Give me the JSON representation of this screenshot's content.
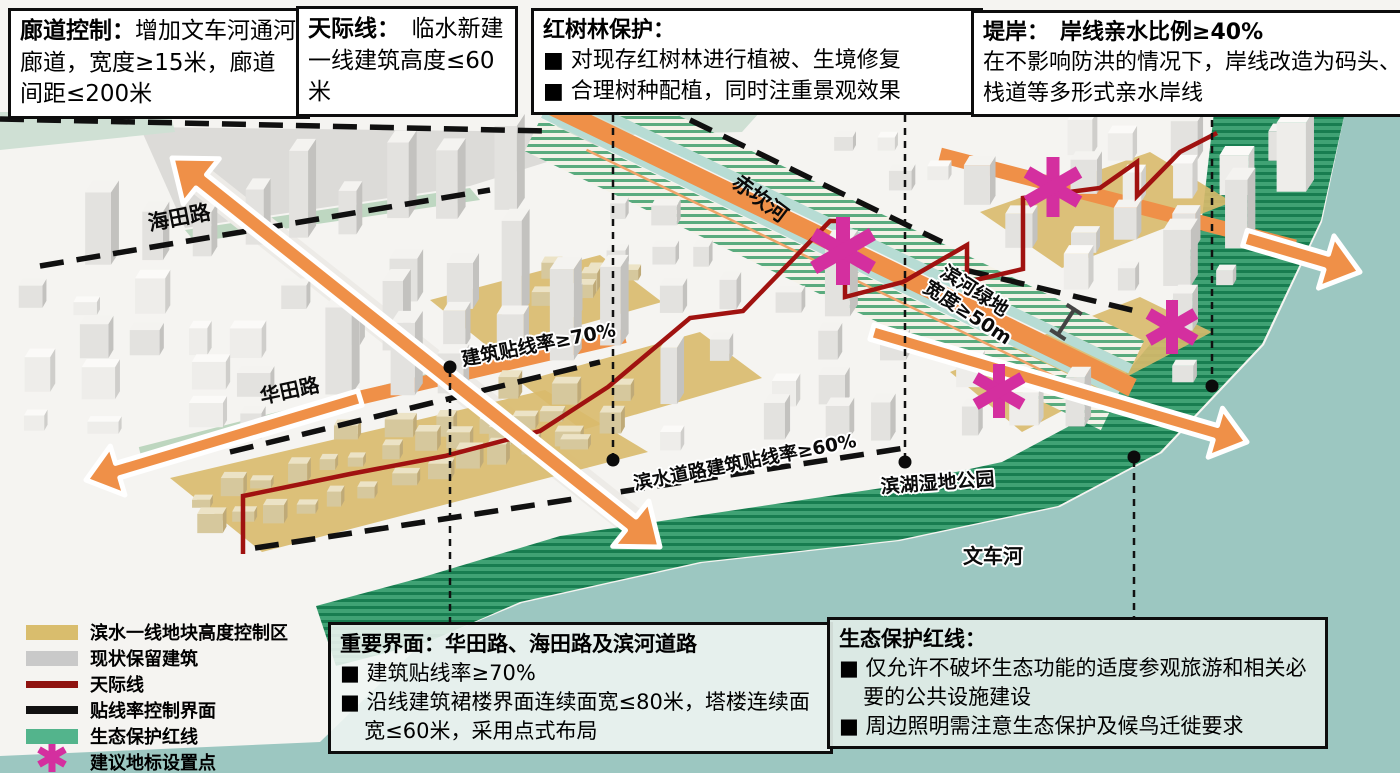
{
  "callouts": [
    {
      "id": "corridor-control",
      "title": "廊道控制：",
      "body": "增加文车河通河廊道，宽度≥15米，廊道间距≤200米"
    },
    {
      "id": "skyline",
      "title": "天际线：",
      "body": "　临水新建一线建筑高度≤60米"
    },
    {
      "id": "mangrove",
      "title": "红树林保护：",
      "bullets": [
        "■ 对现存红树林进行植被、生境修复",
        "■ 合理树种配植，同时注重景观效果"
      ]
    },
    {
      "id": "embankment",
      "title": "堤岸：",
      "subtitle": "　岸线亲水比例≥40%",
      "body": "在不影响防洪的情况下，岸线改造为码头、栈道等多形式亲水岸线"
    },
    {
      "id": "key-interface",
      "title": "重要界面：华田路、海田路及滨河道路",
      "bullets": [
        "■ 建筑贴线率≥70%",
        "■ 沿线建筑裙楼界面连续面宽≤80米，塔楼连续面宽≤60米，采用点式布局"
      ]
    },
    {
      "id": "eco-redline",
      "title": "生态保护红线：",
      "bullets": [
        "■ 仅允许不破坏生态功能的适度参观旅游和相关必要的公共设施建设",
        "■ 周边照明需注意生态保护及候鸟迁徙要求"
      ]
    }
  ],
  "legend": {
    "items": [
      {
        "swatch": "tan",
        "label": "滨水一线地块高度控制区",
        "color": "#d9bd6d"
      },
      {
        "swatch": "gray",
        "label": "现状保留建筑",
        "color": "#c9c9c9"
      },
      {
        "swatch": "redline",
        "label": "天际线",
        "color": "#8f1310"
      },
      {
        "swatch": "blackline",
        "label": "贴线率控制界面",
        "color": "#111111"
      },
      {
        "swatch": "green",
        "label": "生态保护红线",
        "color": "#53b48c"
      },
      {
        "swatch": "asterisk",
        "label": "建议地标设置点",
        "color": "#d42f9f"
      }
    ]
  },
  "map_labels": {
    "haitian_road": "海田路",
    "huatian_road": "华田路",
    "junmin_road": [
      "军",
      "民",
      "路"
    ],
    "chikan_river": "赤坎河",
    "build_to_line_70": "建筑贴线率≥70%",
    "riverside_green": [
      "滨河绿地",
      "宽度≥50m"
    ],
    "waterfront_line_60": "滨水道路建筑贴线率≥60%",
    "wetland_park": "滨湖湿地公园",
    "wenche_river": "文车河"
  },
  "colors": {
    "road_orange": "#ef9048",
    "landmark_magenta": "#d42f9f",
    "skyline_red": "#a01210",
    "interface_black": "#111111",
    "eco_green": "#40a274",
    "water_teal": "#9cc7c1",
    "height_zone_tan": "#d9ba6b",
    "retained_building_gray": "#c9c9c9"
  }
}
